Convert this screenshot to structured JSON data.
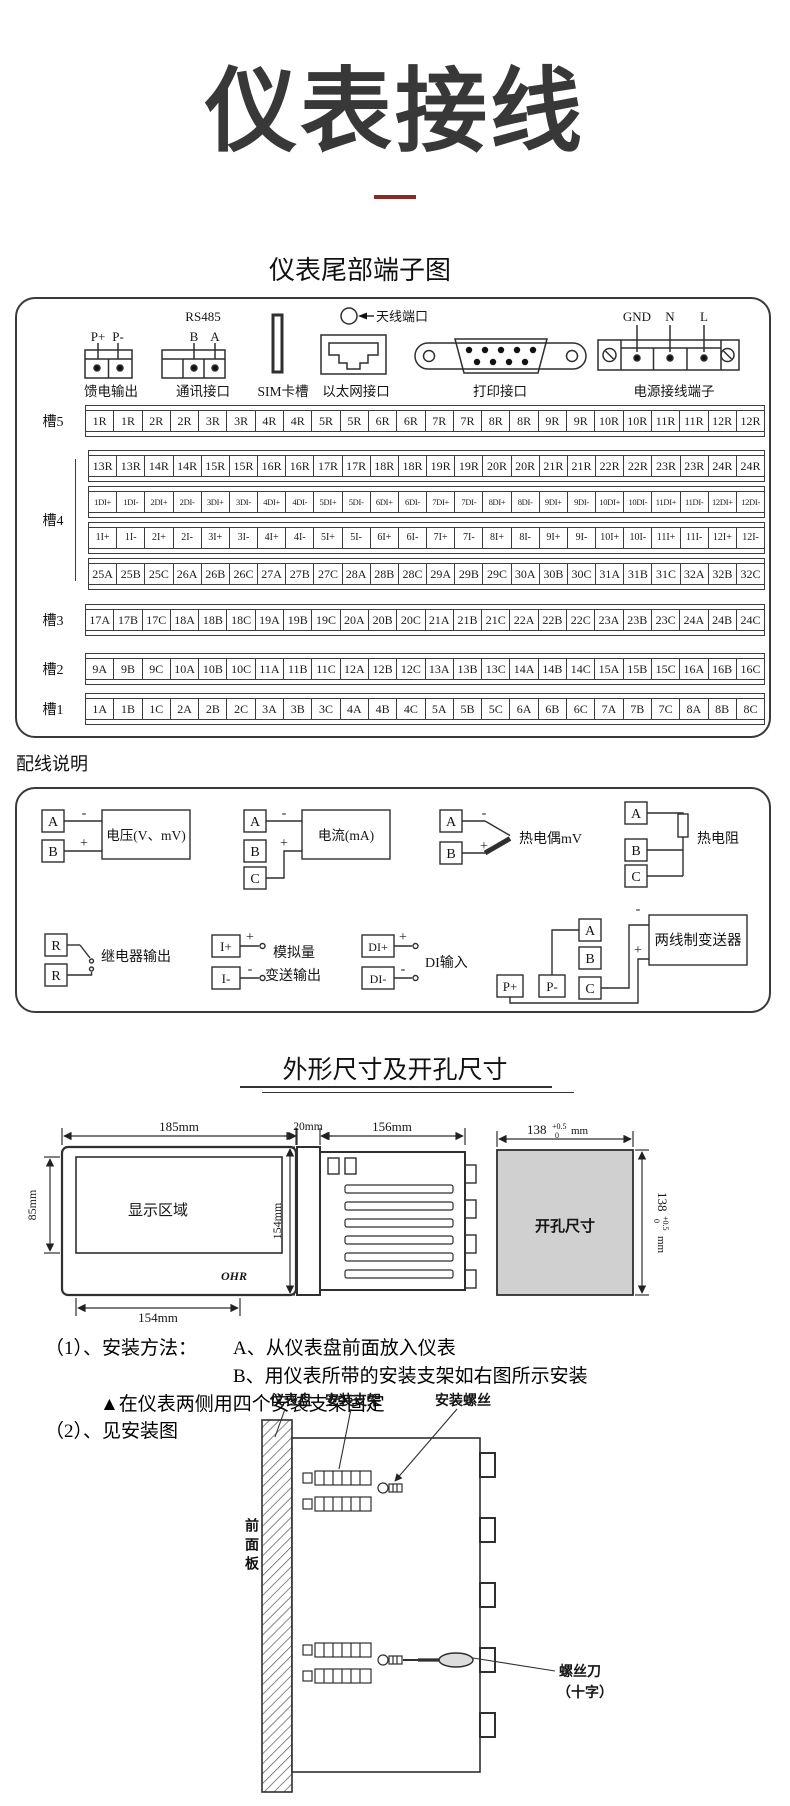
{
  "page": {
    "title": "仪表接线",
    "accent_color": "#8a2a24"
  },
  "terminal": {
    "heading": "仪表尾部端子图",
    "connectors": {
      "feed": {
        "label": "馈电输出",
        "pin1": "P+",
        "pin2": "P-"
      },
      "comm": {
        "label": "通讯接口",
        "bus": "RS485",
        "pin1": "B",
        "pin2": "A"
      },
      "sim": {
        "label": "SIM卡槽"
      },
      "ethernet": {
        "label": "以太网接口"
      },
      "antenna": {
        "label": "天线端口"
      },
      "printer": {
        "label": "打印接口"
      },
      "power": {
        "label": "电源接线端子",
        "pin1": "GND",
        "pin2": "N",
        "pin3": "L"
      }
    },
    "slots": [
      {
        "label": "槽5",
        "rows": [
          [
            "1R",
            "1R",
            "2R",
            "2R",
            "3R",
            "3R",
            "4R",
            "4R",
            "5R",
            "5R",
            "6R",
            "6R",
            "7R",
            "7R",
            "8R",
            "8R",
            "9R",
            "9R",
            "10R",
            "10R",
            "11R",
            "11R",
            "12R",
            "12R"
          ]
        ]
      },
      {
        "label": "槽4",
        "rows": [
          [
            "13R",
            "13R",
            "14R",
            "14R",
            "15R",
            "15R",
            "16R",
            "16R",
            "17R",
            "17R",
            "18R",
            "18R",
            "19R",
            "19R",
            "20R",
            "20R",
            "21R",
            "21R",
            "22R",
            "22R",
            "23R",
            "23R",
            "24R",
            "24R"
          ],
          [
            "1DI+",
            "1DI-",
            "2DI+",
            "2DI-",
            "3DI+",
            "3DI-",
            "4DI+",
            "4DI-",
            "5DI+",
            "5DI-",
            "6DI+",
            "6DI-",
            "7DI+",
            "7DI-",
            "8DI+",
            "8DI-",
            "9DI+",
            "9DI-",
            "10DI+",
            "10DI-",
            "11DI+",
            "11DI-",
            "12DI+",
            "12DI-"
          ],
          [
            "1I+",
            "1I-",
            "2I+",
            "2I-",
            "3I+",
            "3I-",
            "4I+",
            "4I-",
            "5I+",
            "5I-",
            "6I+",
            "6I-",
            "7I+",
            "7I-",
            "8I+",
            "8I-",
            "9I+",
            "9I-",
            "10I+",
            "10I-",
            "11I+",
            "11I-",
            "12I+",
            "12I-"
          ],
          [
            "25A",
            "25B",
            "25C",
            "26A",
            "26B",
            "26C",
            "27A",
            "27B",
            "27C",
            "28A",
            "28B",
            "28C",
            "29A",
            "29B",
            "29C",
            "30A",
            "30B",
            "30C",
            "31A",
            "31B",
            "31C",
            "32A",
            "32B",
            "32C"
          ]
        ]
      },
      {
        "label": "槽3",
        "rows": [
          [
            "17A",
            "17B",
            "17C",
            "18A",
            "18B",
            "18C",
            "19A",
            "19B",
            "19C",
            "20A",
            "20B",
            "20C",
            "21A",
            "21B",
            "21C",
            "22A",
            "22B",
            "22C",
            "23A",
            "23B",
            "23C",
            "24A",
            "24B",
            "24C"
          ]
        ]
      },
      {
        "label": "槽2",
        "rows": [
          [
            "9A",
            "9B",
            "9C",
            "10A",
            "10B",
            "10C",
            "11A",
            "11B",
            "11C",
            "12A",
            "12B",
            "12C",
            "13A",
            "13B",
            "13C",
            "14A",
            "14B",
            "14C",
            "15A",
            "15B",
            "15C",
            "16A",
            "16B",
            "16C"
          ]
        ]
      },
      {
        "label": "槽1",
        "rows": [
          [
            "1A",
            "1B",
            "1C",
            "2A",
            "2B",
            "2C",
            "3A",
            "3B",
            "3C",
            "4A",
            "4B",
            "4C",
            "5A",
            "5B",
            "5C",
            "6A",
            "6B",
            "6C",
            "7A",
            "7B",
            "7C",
            "8A",
            "8B",
            "8C"
          ]
        ]
      }
    ]
  },
  "wiring": {
    "heading": "配线说明",
    "voltage": {
      "t1": "A",
      "t2": "B",
      "minus": "-",
      "plus": "+",
      "label": "电压(V、mV)"
    },
    "current": {
      "t1": "A",
      "t2": "B",
      "t3": "C",
      "minus": "-",
      "plus": "+",
      "label": "电流(mA)"
    },
    "thermocouple": {
      "t1": "A",
      "t2": "B",
      "minus": "-",
      "plus": "+",
      "label": "热电偶mV"
    },
    "rtd": {
      "t1": "A",
      "t2": "B",
      "t3": "C",
      "label": "热电阻"
    },
    "relay": {
      "t1": "R",
      "t2": "R",
      "label": "继电器输出"
    },
    "analog": {
      "t1": "I+",
      "t2": "I-",
      "plus": "+",
      "minus": "-",
      "label1": "模拟量",
      "label2": "变送输出"
    },
    "di": {
      "t1": "DI+",
      "t2": "DI-",
      "plus": "+",
      "minus": "-",
      "label": "DI输入"
    },
    "transmitter": {
      "t1": "A",
      "t2": "B",
      "t3": "C",
      "p1": "P+",
      "p2": "P-",
      "minus": "-",
      "plus": "+",
      "label": "两线制变送器"
    }
  },
  "dimensions": {
    "heading": "外形尺寸及开孔尺寸",
    "front": {
      "width": "185mm",
      "height": "85mm",
      "screen": "显示区域",
      "brand": "OHR",
      "bottom": "154mm"
    },
    "side": {
      "flange": "20mm",
      "depth": "156mm",
      "height": "154mm"
    },
    "cutout": {
      "label": "开孔尺寸",
      "w": "138",
      "w_sup": "+0.5",
      "w_sub": "0",
      "w_unit": "mm",
      "h": "138",
      "h_sup": "+0.5",
      "h_sub": "0",
      "h_unit": "mm"
    }
  },
  "install": {
    "step1": "（1）、安装方法：",
    "step1_a": "A、从仪表盘前面放入仪表",
    "step1_b": "B、用仪表所带的安装支架如右图所示安装",
    "note": "▲在仪表两侧用四个安装支架固定",
    "step2": "（2）、见安装图",
    "labels": {
      "panel": "仪表盘",
      "bracket": "安装支架",
      "screw": "安装螺丝",
      "front_panel": "前面板",
      "tool1": "螺丝刀",
      "tool2": "（十字）"
    }
  }
}
